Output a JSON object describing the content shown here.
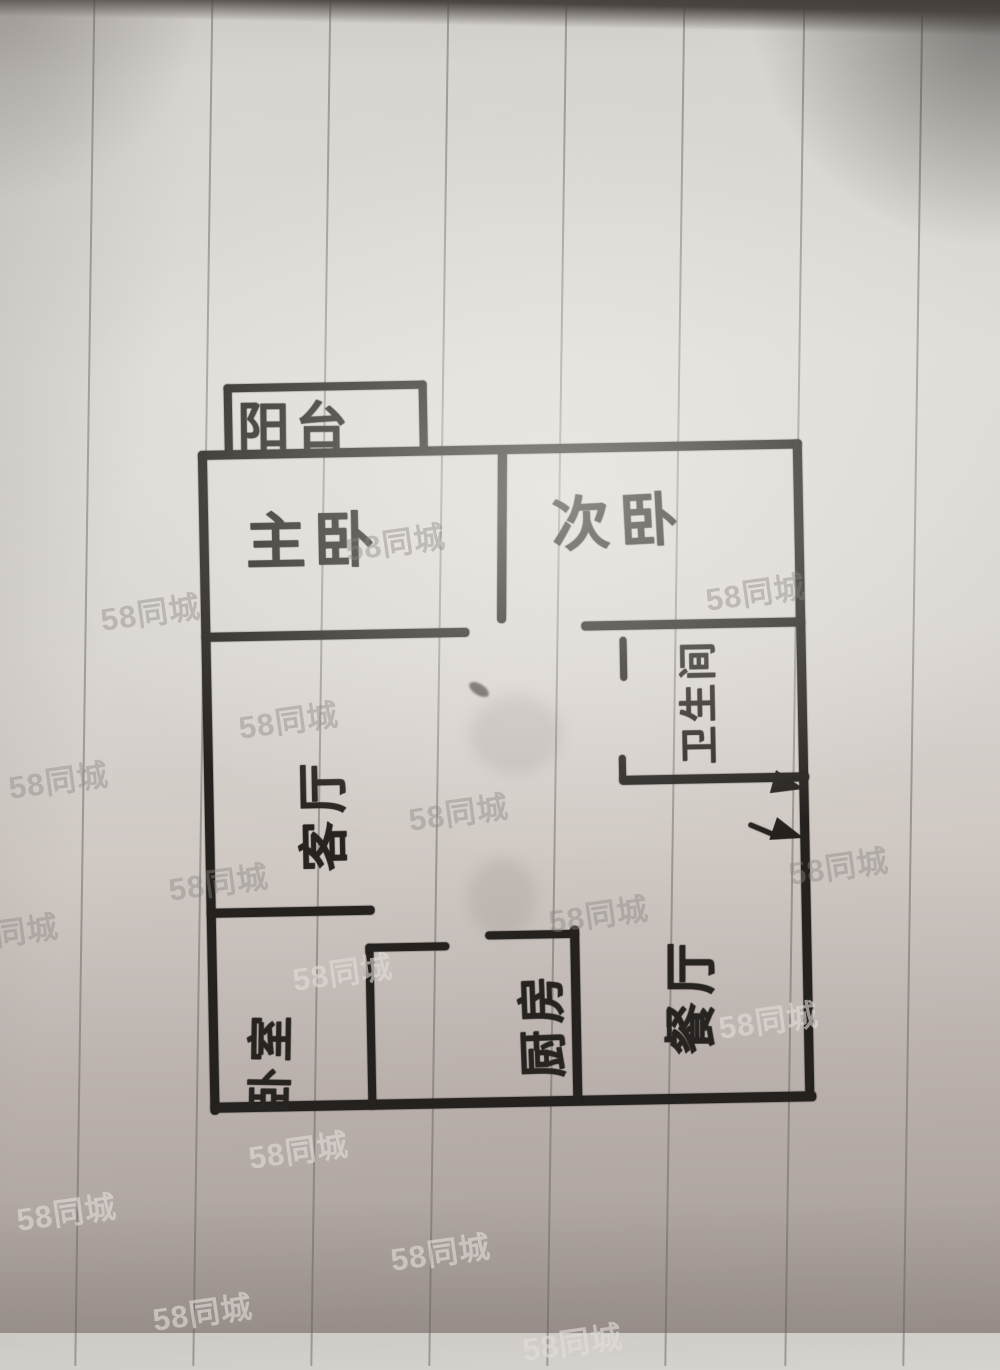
{
  "scene": {
    "description": "Hand-drawn apartment floor plan, marker on vertically ruled notebook paper (photo)",
    "drawing_type": "floor plan sketch"
  },
  "watermark": {
    "text": "58同城",
    "instances": [
      {
        "x": 100,
        "y": 588,
        "light": false
      },
      {
        "x": 345,
        "y": 518,
        "light": false
      },
      {
        "x": 705,
        "y": 568,
        "light": false
      },
      {
        "x": 238,
        "y": 696,
        "light": false
      },
      {
        "x": 8,
        "y": 756,
        "light": false
      },
      {
        "x": 408,
        "y": 788,
        "light": false
      },
      {
        "x": 168,
        "y": 858,
        "light": false
      },
      {
        "x": -42,
        "y": 908,
        "light": false
      },
      {
        "x": 788,
        "y": 842,
        "light": false
      },
      {
        "x": 548,
        "y": 890,
        "light": false
      },
      {
        "x": 292,
        "y": 948,
        "light": true
      },
      {
        "x": 718,
        "y": 996,
        "light": true
      },
      {
        "x": 248,
        "y": 1126,
        "light": true
      },
      {
        "x": 16,
        "y": 1188,
        "light": true
      },
      {
        "x": 390,
        "y": 1228,
        "light": true
      },
      {
        "x": 152,
        "y": 1288,
        "light": true
      },
      {
        "x": 522,
        "y": 1318,
        "light": true
      }
    ]
  },
  "rooms": {
    "balcony": {
      "label": "阳台",
      "orientation": "horizontal"
    },
    "master_bedroom": {
      "label": "主卧",
      "orientation": "horizontal"
    },
    "second_bedroom": {
      "label": "次卧",
      "orientation": "horizontal"
    },
    "bathroom": {
      "label": "卫生间",
      "orientation": "rotated-90"
    },
    "living_room": {
      "label": "客厅",
      "orientation": "rotated-90"
    },
    "bedroom": {
      "label": "卧室",
      "orientation": "rotated-90"
    },
    "kitchen": {
      "label": "厨房",
      "orientation": "rotated-90"
    },
    "dining_room": {
      "label": "餐厅",
      "orientation": "rotated-90"
    }
  },
  "annotations": {
    "door_arrows_count": 2
  },
  "colors": {
    "ink": "#24211e",
    "paper_light": "#dfdcd8",
    "paper_dark": "#a59c98",
    "rule_line": "#68645f",
    "watermark_gray": "#8a8582",
    "watermark_light": "#e2ddd9"
  }
}
